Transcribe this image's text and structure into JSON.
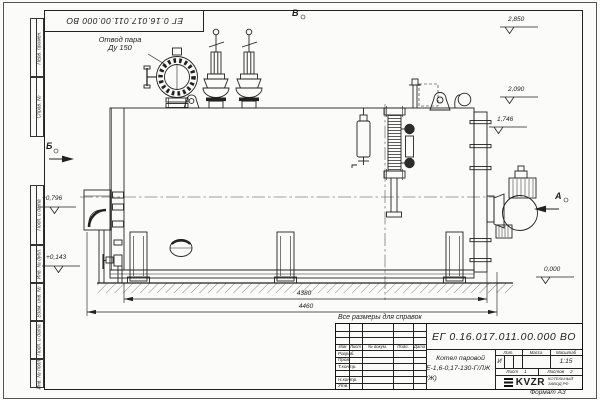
{
  "drawing": {
    "designation_inverted": "ЕГ 0.16.017.011.00.000  ВО",
    "format": "Формат А3",
    "reference_note": "Все размеры для справок"
  },
  "callout": {
    "line1": "Отвод пара",
    "line2": "Ду 150"
  },
  "views": {
    "a": "А",
    "b": "Б",
    "v": "В"
  },
  "elevations": {
    "top": "2,850",
    "mid": "2,090",
    "shell_top": "1,746",
    "ground": "0,000",
    "left_upper": "+0,796",
    "left_lower": "+0,143"
  },
  "dimensions": {
    "inner": "4380",
    "overall": "4460"
  },
  "margin_boxes": [
    "Перв. примен.",
    "Справ. №",
    "Подп. и дата",
    "Инв. № дубл.",
    "Взам. инв. №",
    "Подп. и дата",
    "Инв. № подл."
  ],
  "title_block": {
    "designation": "ЕГ 0.16.017.011.00.000  ВО",
    "product_name_line1": "Котел паровой",
    "product_name_line2": "Е-1,6-0,17-130-Г/ЛЖ (Ж)",
    "col_izm": "Изм",
    "col_list": "Лист",
    "col_doc": "№ докум.",
    "col_podp": "Подп.",
    "col_data": "Дата",
    "row_razrab": "Разраб.",
    "row_prov": "Пров.",
    "row_tkontr": "Т.контр.",
    "row_nkontr": "Н.контр.",
    "row_utv": "Утв.",
    "lit_header": "Лит.",
    "mass_header": "Масса",
    "scale_header": "Масштаб",
    "lit_value": "И",
    "scale_value": "1:15",
    "sheet_label": "Лист",
    "sheet_value": "1",
    "sheets_label": "Листов",
    "sheets_value": "2",
    "logo": "KVZR",
    "logo_sub1": "КОТЕЛЬНЫЙ",
    "logo_sub2": "ЗАВОД РФ"
  }
}
